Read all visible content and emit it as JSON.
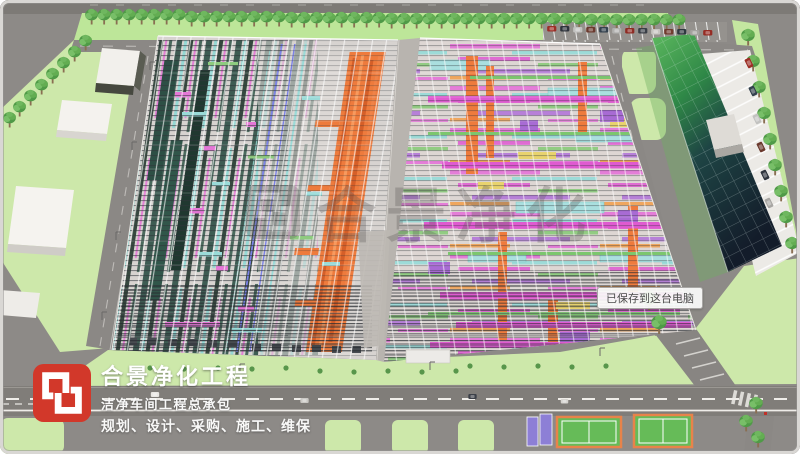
{
  "branding": {
    "company_name": "合景净化工程",
    "tagline": "洁净车间工程总承包",
    "services": "规划、设计、采购、施工、维保",
    "brand_red": "#d2382a"
  },
  "watermark": {
    "text": "合景净化"
  },
  "notification": {
    "text": "已保存到这台电脑"
  },
  "scene": {
    "mep_colors": {
      "duct_orange": "#ee7b3d",
      "pipe_magenta": "#e478d8",
      "pipe_cyan": "#9adbd8",
      "pipe_green": "#8ecb7f",
      "pipe_purple": "#b57bd8",
      "pipe_yellow": "#e8d36e",
      "equipment_teal": "#2d4f45"
    },
    "site_colors": {
      "grass": "#cde8aa",
      "road": "#868380",
      "factory_roof": "#d7d3d0",
      "tower_glass_green": "#4ca853",
      "tower_dark": "#141e2c",
      "parking": "#eceae6",
      "court_green": "#66bb58",
      "court_orange_border": "#e8834a",
      "court_purple": "#8d7fd6"
    }
  }
}
